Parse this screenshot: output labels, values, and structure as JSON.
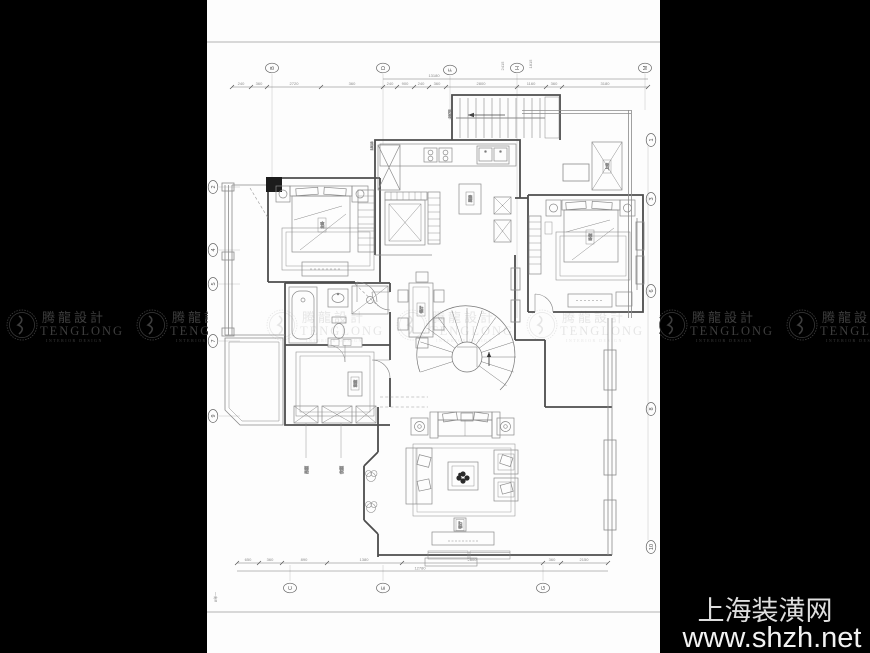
{
  "watermark": {
    "brand_cn": "腾龍設計",
    "brand_en": "TENGLONG",
    "brand_sub": "INTERIOR DESIGN"
  },
  "footer": {
    "site_name": "上海装潢网",
    "site_url": "www.shzh.net"
  },
  "grid": {
    "top": [
      "B",
      "D",
      "F",
      "H",
      "M"
    ],
    "bottom": [
      "C",
      "E",
      "G"
    ],
    "left": [
      "2",
      "4",
      "5",
      "7",
      "9"
    ],
    "right": [
      "1",
      "3",
      "6",
      "8",
      "10"
    ]
  },
  "dimensions": {
    "top": [
      "240",
      "360",
      "2720",
      "360",
      "240",
      "900",
      "240",
      "360",
      "2800",
      "1160",
      "360",
      "3180"
    ],
    "top_total": "13180",
    "bottom": [
      "650",
      "360",
      "890",
      "1380",
      "2800",
      "360",
      "2150"
    ],
    "bottom_total": "12780",
    "top_note_a": "2415",
    "top_note_b": "1815",
    "stair_note": "2975",
    "note_left": "1818",
    "sheet_note": "8单一"
  },
  "rooms": {
    "kitchen": "厨房",
    "dining": "餐厅",
    "master_bedroom": "主卧",
    "bedroom": "卧室",
    "tatami": "和室",
    "living": "客厅",
    "void": "上空"
  },
  "callouts": {
    "closet_a": "吊柜",
    "closet_b": "衣柜"
  }
}
